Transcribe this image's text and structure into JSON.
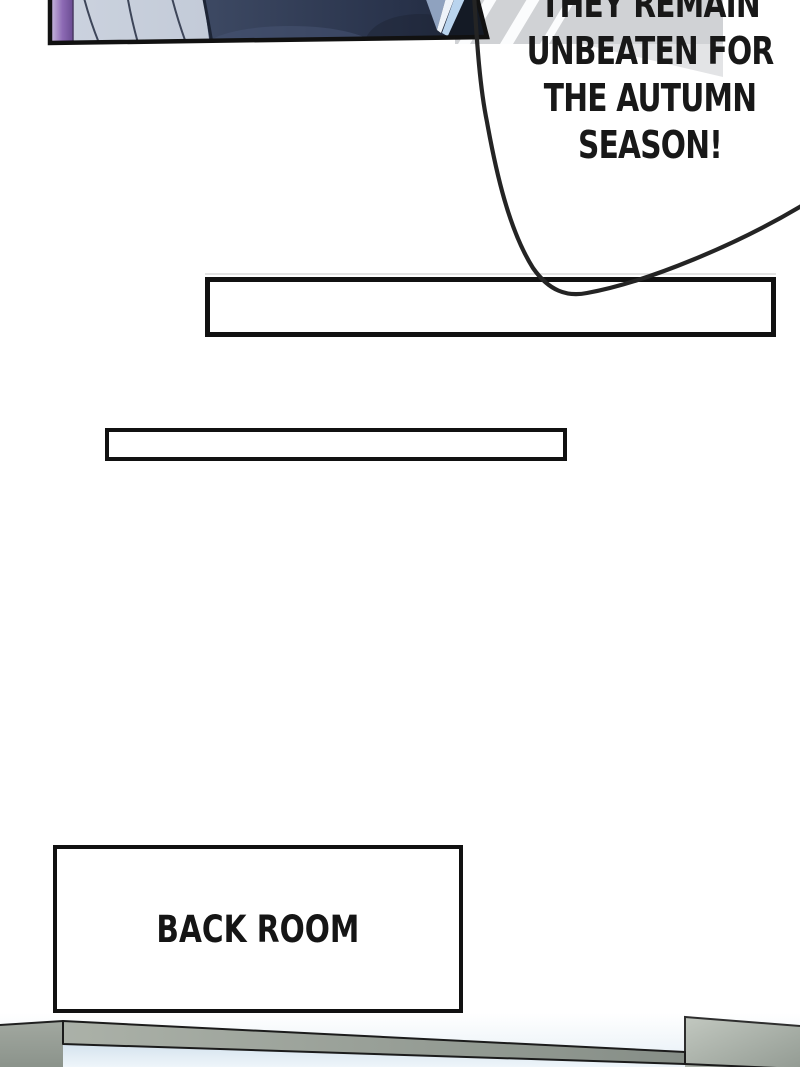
{
  "page": {
    "width": 800,
    "height": 1067
  },
  "speech": {
    "lines": [
      "THEY REMAIN",
      "UNBEATEN FOR",
      "THE AUTUMN",
      "SEASON!"
    ]
  },
  "sign": {
    "label": "BACK ROOM"
  },
  "caption_boxes": {
    "box_1_text": "",
    "box_2_text": ""
  },
  "colors": {
    "ink": "#111111",
    "speech_text": "#181818",
    "paper_white": "#ffffff",
    "fabric_blue": "#c6cedb",
    "suit_navy": "#27324a",
    "hair_purple": "#8d6ab4",
    "building_gray": "#d0d2d5",
    "counter_gray": "#8e968e",
    "glass_blue": "#d8e5ef"
  }
}
